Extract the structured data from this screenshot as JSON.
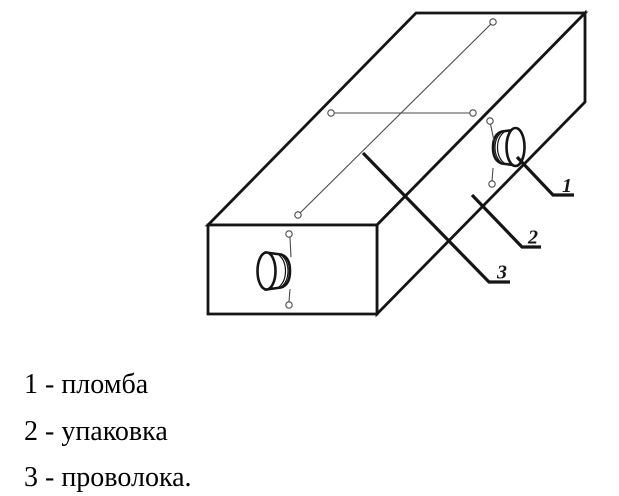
{
  "diagram": {
    "kind": "technical-line-drawing",
    "callouts": [
      {
        "label": "1"
      },
      {
        "label": "2"
      },
      {
        "label": "3"
      }
    ],
    "colors": {
      "outline": "#151515",
      "wire": "#4a4a4a",
      "background": "#ffffff",
      "text": "#000000"
    }
  },
  "legend": {
    "items": [
      {
        "text": "1 - пломба"
      },
      {
        "text": "2 - упаковка"
      },
      {
        "text": "3 - проволока."
      }
    ]
  }
}
